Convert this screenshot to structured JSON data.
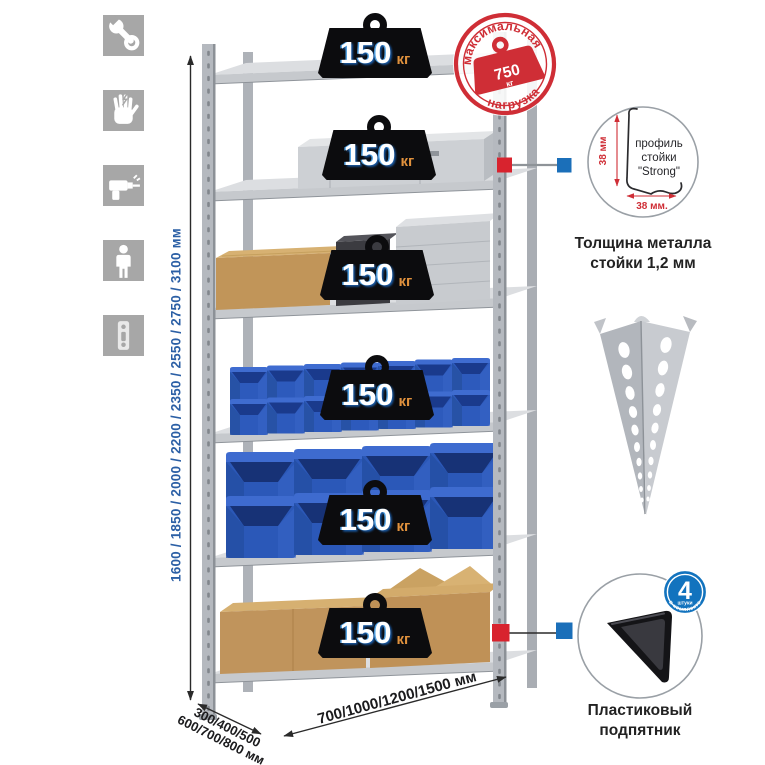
{
  "colors": {
    "accent_red": "#d8232e",
    "accent_blue": "#1b6fb9",
    "bin_blue": "#2d5abc",
    "dimension_text_blue": "#2b5fa5",
    "stamp_red": "#cf2e36",
    "icon_gray": "#a7a7a7"
  },
  "left_toolbar": {
    "icons": [
      {
        "name": "wrench-icon"
      },
      {
        "name": "work-gloves-icon"
      },
      {
        "name": "drill-icon"
      },
      {
        "name": "person-height-icon"
      },
      {
        "name": "perforated-profile-icon"
      }
    ]
  },
  "dimension_labels": {
    "height": "1600 / 1850 / 2000 / 2200 / 2350 / 2550 / 2750 / 3100 мм",
    "depth_line1": "300/400/500",
    "depth_line2": "600/700/800 мм",
    "width": "700/1000/1200/1500 мм"
  },
  "shelf_load_badges": [
    {
      "value": "150",
      "unit": "кг"
    },
    {
      "value": "150",
      "unit": "кг"
    },
    {
      "value": "150",
      "unit": "кг"
    },
    {
      "value": "150",
      "unit": "кг"
    },
    {
      "value": "150",
      "unit": "кг"
    },
    {
      "value": "150",
      "unit": "кг"
    }
  ],
  "max_load_stamp": {
    "arc_top": "максимальная",
    "arc_bottom": "нагрузка",
    "value": "750",
    "unit": "кг"
  },
  "post_profile_detail": {
    "label_line1": "профиль",
    "label_line2": "стойки",
    "label_line3": "\"Strong\"",
    "dim_height": "38 мм",
    "dim_width": "38 мм.",
    "caption_line1": "Толщина металла",
    "caption_line2": "стойки 1,2 мм"
  },
  "foot_detail": {
    "badge_value": "4",
    "badge_unit": "штуки",
    "badge_arc": "в комплекте",
    "caption_line1": "Пластиковый",
    "caption_line2": "подпятник"
  }
}
